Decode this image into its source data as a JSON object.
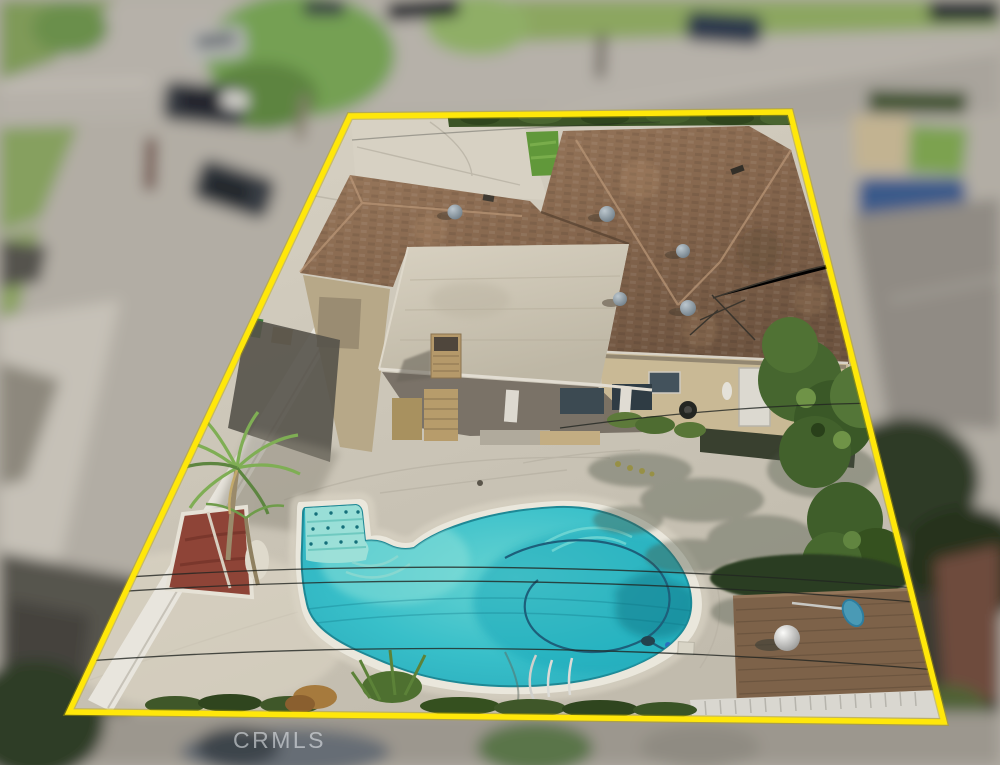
{
  "image": {
    "kind": "aerial-drone-photo",
    "subject": "single-family home with kidney-shaped swimming pool and yellow property boundary outline",
    "watermark": "CRMLS"
  },
  "colors": {
    "boundary_line": "#ffe70a",
    "pool_water": "#35bfc9",
    "pool_shallow": "#9ce2da",
    "pool_coping": "#eae7dc",
    "roof_shingle": "#8a6950",
    "roof_flat": "#cfc8b6",
    "deck_concrete": "#ccc6b8",
    "lawn_green": "#61983a",
    "hedge_green": "#3c5426",
    "planter_red": "#8e4437",
    "fence_white": "#e8e5dd",
    "shed_roof": "#7d6249",
    "watermark_text": "rgba(238,240,244,0.55)"
  }
}
